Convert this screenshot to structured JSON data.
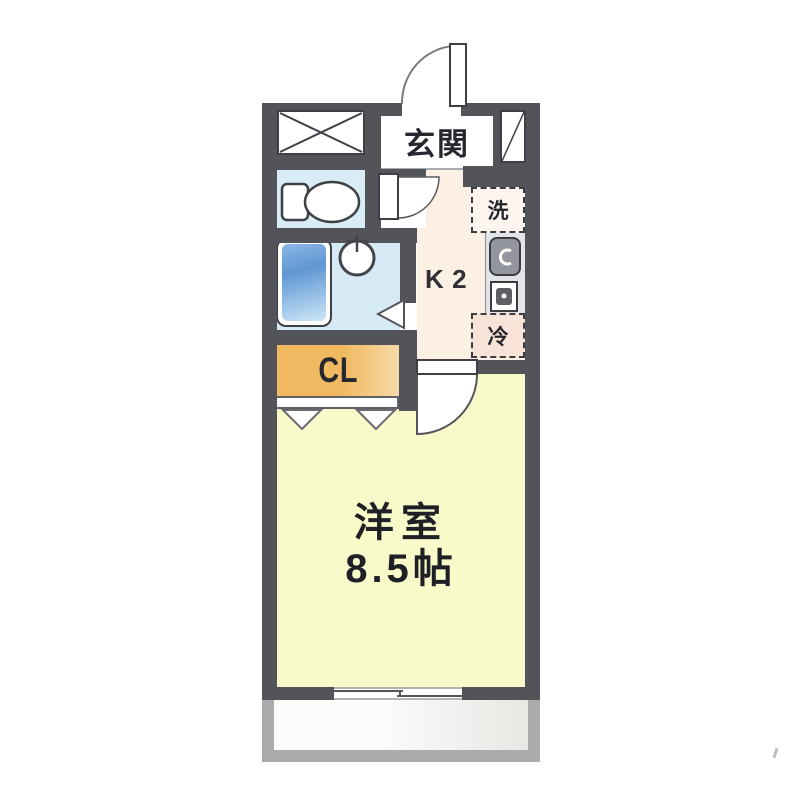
{
  "plan_type": "floor-plan",
  "rooms": {
    "entrance": {
      "label": "玄関"
    },
    "kitchen": {
      "label": "K2"
    },
    "closet": {
      "label": "CL"
    },
    "washer": {
      "label": "洗"
    },
    "fridge": {
      "label": "冷"
    },
    "main_room": {
      "name": "洋室",
      "size": "8.5帖"
    }
  },
  "colors": {
    "wall": "#53545a",
    "toilet_floor": "#d8edf6",
    "bath_floor": "#d5eaf4",
    "bathtub_blue": "#5f97d3",
    "kitchen_floor": "#fcf0e5",
    "closet_orange": "#f1ba62",
    "main_room_floor": "#f9fac9",
    "washer_bg": "#fdf5ee",
    "fridge_bg": "#f8e3d8",
    "counter_gray": "#e3e4e8",
    "balcony_frame": "#ababab"
  }
}
